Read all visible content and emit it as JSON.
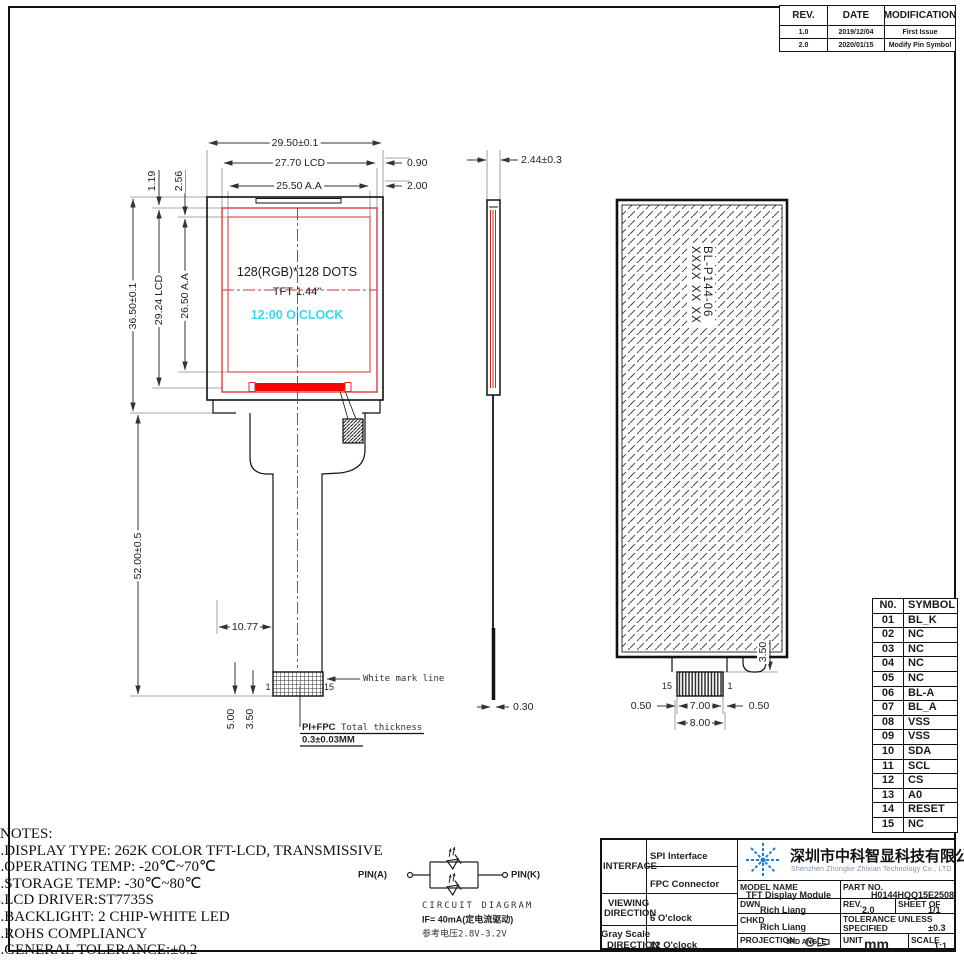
{
  "colors": {
    "red_outline": "#d32f2f",
    "red_fill": "#ff0000",
    "cyan": "#35dcee",
    "line": "#222222",
    "logo_blue": "#1c7fd6"
  },
  "revision": {
    "headers": [
      "REV.",
      "DATE",
      "MODIFICATION"
    ],
    "rows": [
      [
        "1.0",
        "2019/12/04",
        "First Issue"
      ],
      [
        "2.0",
        "2020/01/15",
        "Modify Pin Symbol"
      ]
    ]
  },
  "front": {
    "dim_width_total": "29.50±0.1",
    "dim_width_lcd": "27.70 LCD",
    "dim_width_aa": "25.50 A.A",
    "dim_edge_090": "0.90",
    "dim_edge_200": "2.00",
    "dim_edge_119": "1.19",
    "dim_edge_256": "2.56",
    "dim_height_total": "36.50±0.1",
    "dim_height_lcd": "29.24 LCD",
    "dim_height_aa": "26.50 A.A",
    "dim_fpc_length": "52.00±0.5",
    "dim_tail": "10.77",
    "dim_500": "5.00",
    "dim_350": "3.50",
    "screen_line1": "128(RGB)*128  DOTS",
    "screen_line2": "TFT 1.44\"",
    "screen_line3": "12:00  O'CLOCK",
    "pin_first": "1",
    "pin_last": "15",
    "white_mark": "White mark line",
    "thickness_bold": "PI+FPC",
    "thickness_rest": " Total thickness",
    "thickness_value": "0.3±0.03MM"
  },
  "side": {
    "dim_thickness": "2.44±0.3",
    "dim_fpc": "0.30"
  },
  "back": {
    "text_line1": "BL-P144-06",
    "text_line2": "XXXX XX XX",
    "pin_left": "15",
    "pin_right": "1",
    "dim_050l": "0.50",
    "dim_700": "7.00",
    "dim_050r": "0.50",
    "dim_800": "8.00",
    "dim_350": "3.50"
  },
  "pin_table": {
    "col_no": "N0.",
    "col_symbol": "SYMBOL",
    "rows": [
      [
        "01",
        "BL_K"
      ],
      [
        "02",
        "NC"
      ],
      [
        "03",
        "NC"
      ],
      [
        "04",
        "NC"
      ],
      [
        "05",
        "NC"
      ],
      [
        "06",
        "BL-A"
      ],
      [
        "07",
        "BL_A"
      ],
      [
        "08",
        "VSS"
      ],
      [
        "09",
        "VSS"
      ],
      [
        "10",
        "SDA"
      ],
      [
        "11",
        "SCL"
      ],
      [
        "12",
        "CS"
      ],
      [
        "13",
        "A0"
      ],
      [
        "14",
        "RESET"
      ],
      [
        "15",
        "NC"
      ]
    ]
  },
  "notes": {
    "title": "NOTES:",
    "lines": [
      "1.DISPLAY TYPE: 262K COLOR TFT-LCD, TRANSMISSIVE",
      "2.OPERATING TEMP: -20℃~70℃",
      "3.STORAGE TEMP: -30℃~80℃",
      "4.LCD DRIVER:ST7735S",
      "5.BACKLIGHT: 2 CHIP-WHITE LED",
      "6.ROHS COMPLIANCY",
      "7.GENERAL TOLERANCE:±0.2"
    ]
  },
  "circuit": {
    "pin_a": "PIN(A)",
    "pin_k": "PIN(K)",
    "title": "CIRCUIT DIAGRAM",
    "current": "IF= 40mA(定电流驱动)",
    "voltage": "参考电压2.8V-3.2V"
  },
  "titleblock": {
    "interface_label": "INTERFACE",
    "interface_1": "SPI Interface",
    "interface_2": "FPC Connector",
    "viewing_1": "VIEWING",
    "viewing_2": "DIRECTION",
    "viewing_value": "6 O'clock",
    "gray_1": "Gray Scale",
    "gray_2": "DIRECTION",
    "gray_value": "12 O'clock",
    "company_cn": "深圳市中科智显科技有限公司",
    "company_en": "Shenzhen Zhongke Zhixian Technology Co., LTD",
    "model_label": "MODEL NAME",
    "model_value": "TFT Display Module",
    "part_label": "PART NO.",
    "part_value": "H0144HQQ15E2508",
    "dwn_label": "DWN",
    "dwn_value": "Rich Liang",
    "rev_label": "REV.",
    "rev_value": "2.0",
    "sheet_label": "SHEET OF",
    "sheet_value": "1/1",
    "chkd_label": "CHKD",
    "chkd_value": "Rich Liang",
    "tol_label1": "TOLERANCE UNLESS",
    "tol_label2": "SPECIFIED",
    "tol_value": "±0.3",
    "proj_label": "PROJECTION",
    "proj_angle": "3RD ANGLE",
    "unit_label": "UNIT",
    "unit_value": "mm",
    "scale_label": "SCALE",
    "scale_value": "1:1"
  }
}
